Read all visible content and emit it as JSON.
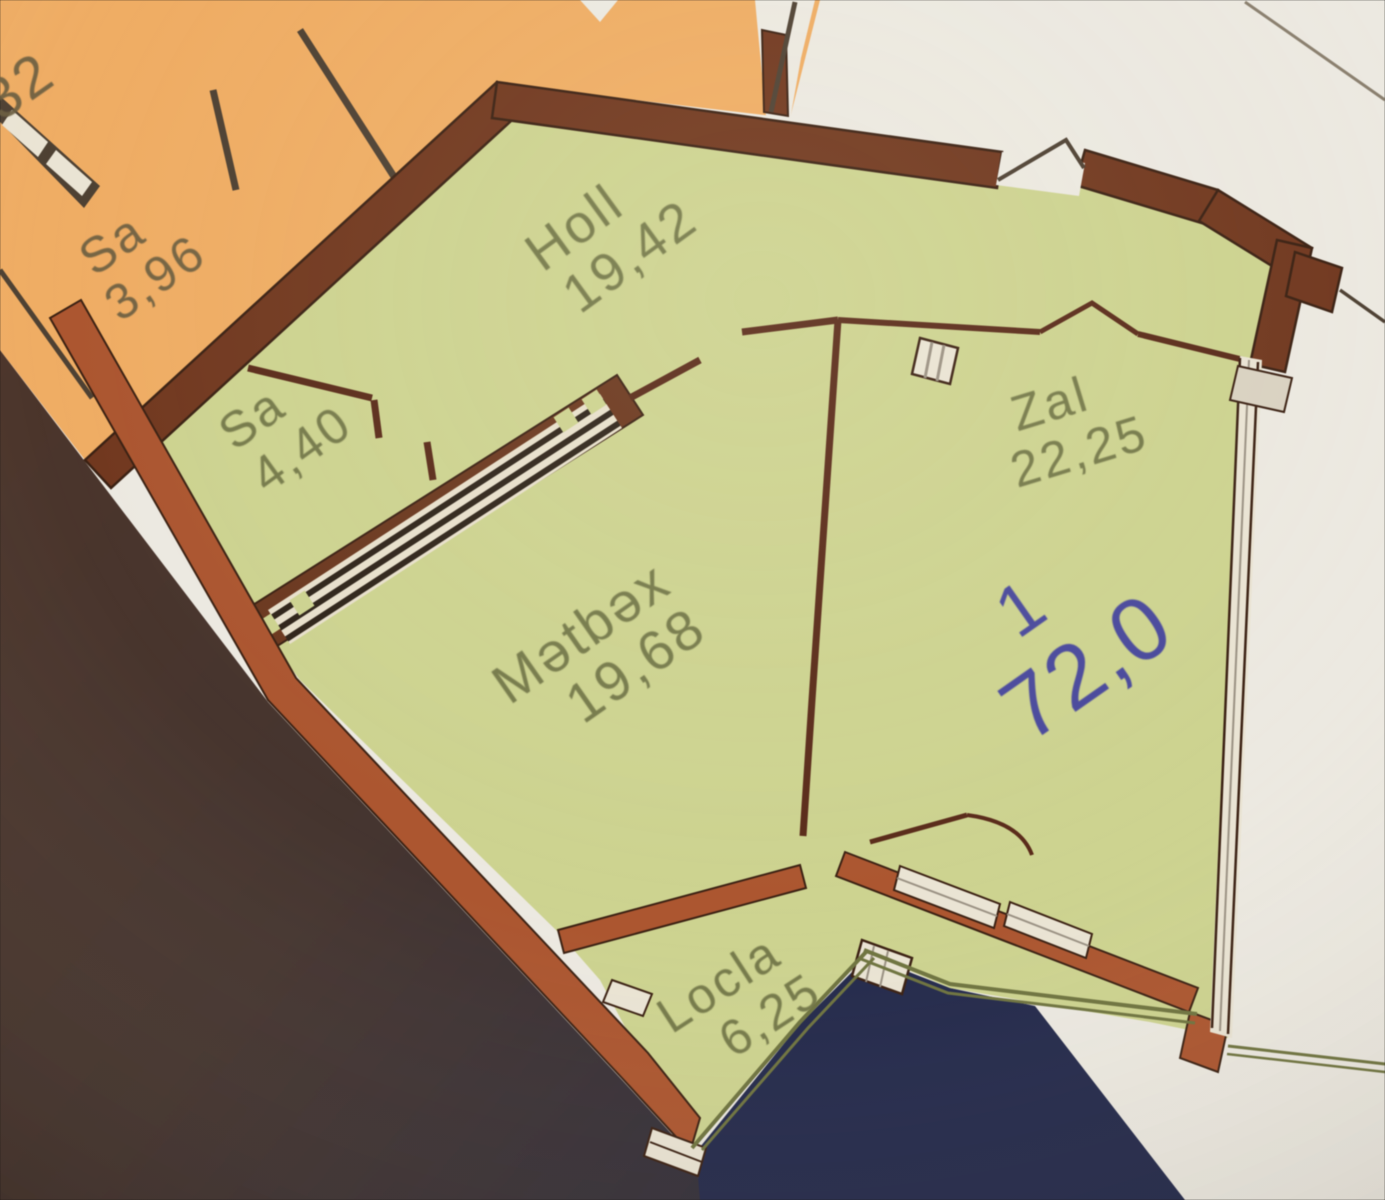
{
  "plan_title": "Apartment floor plan",
  "unit": {
    "number": "1",
    "total_area": "72,0"
  },
  "rooms": [
    {
      "name": "Holl",
      "area": "19,42"
    },
    {
      "name": "Sa",
      "area": "4,40"
    },
    {
      "name": "Mətbəx",
      "area": "19,68"
    },
    {
      "name": "Zal",
      "area": "22,25"
    },
    {
      "name": "Locla",
      "area": "6,25"
    }
  ],
  "neighbor": {
    "room_name": "Sa",
    "room_area": "3,96",
    "partial_area": "32"
  },
  "colors": {
    "paper": "#ECE9E1",
    "plan_green": "#CDD390",
    "orange": "#EFAD64",
    "wall_maroon": "#71381F",
    "wall_rust": "#AC5630",
    "wall_outline": "#3B2113",
    "interior_wall": "#5A2B1A",
    "window_fill": "#EAE4D4",
    "window_cap": "#D9D2C2",
    "text_green": "#6E7245",
    "text_orange": "#6B5E41",
    "text_blue": "#3E3D9E",
    "navy": "#242A4C",
    "dark_edge": "#46312A",
    "balcony_edge": "#6F7440",
    "neighbor_wall_gray": "#4E4133"
  }
}
